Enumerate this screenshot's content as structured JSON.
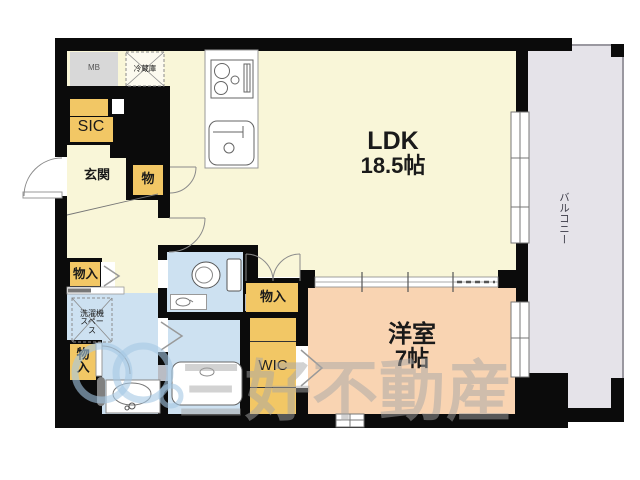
{
  "plan_title": "1LDK apartment floor plan",
  "rooms": {
    "ldk": {
      "label": "LDK",
      "size": "18.5帖"
    },
    "bedroom": {
      "label": "洋室",
      "size": "7帖"
    },
    "balcony": {
      "label": "バルコニー"
    },
    "entrance": {
      "label": "玄関"
    },
    "sic": {
      "label": "SIC"
    },
    "wic": {
      "label": "WIC"
    }
  },
  "fixtures": {
    "meter_box": {
      "label": "MB"
    },
    "refrigerator": {
      "label": "冷蔵庫"
    },
    "washer_space": {
      "label": "洗濯機スペース"
    },
    "closet_hall": {
      "label": "物入"
    },
    "closet_ldk": {
      "label": "物入"
    },
    "closet_washroom": {
      "label": "物入"
    },
    "closet_entrance": {
      "label": "物"
    }
  },
  "watermark": {
    "company": "三好不動産"
  },
  "colors": {
    "ldk_floor": "#f9f6d8",
    "bedroom_floor": "#f9d4b2",
    "wet_area_floor": "#cde1f1",
    "closet_fill": "#f2c765",
    "balcony_fill": "#e5e3e9",
    "meter_box_fill": "#d8d8d8",
    "wall": "#0b0b0b",
    "watermark_gray": "#a5a5a5"
  }
}
